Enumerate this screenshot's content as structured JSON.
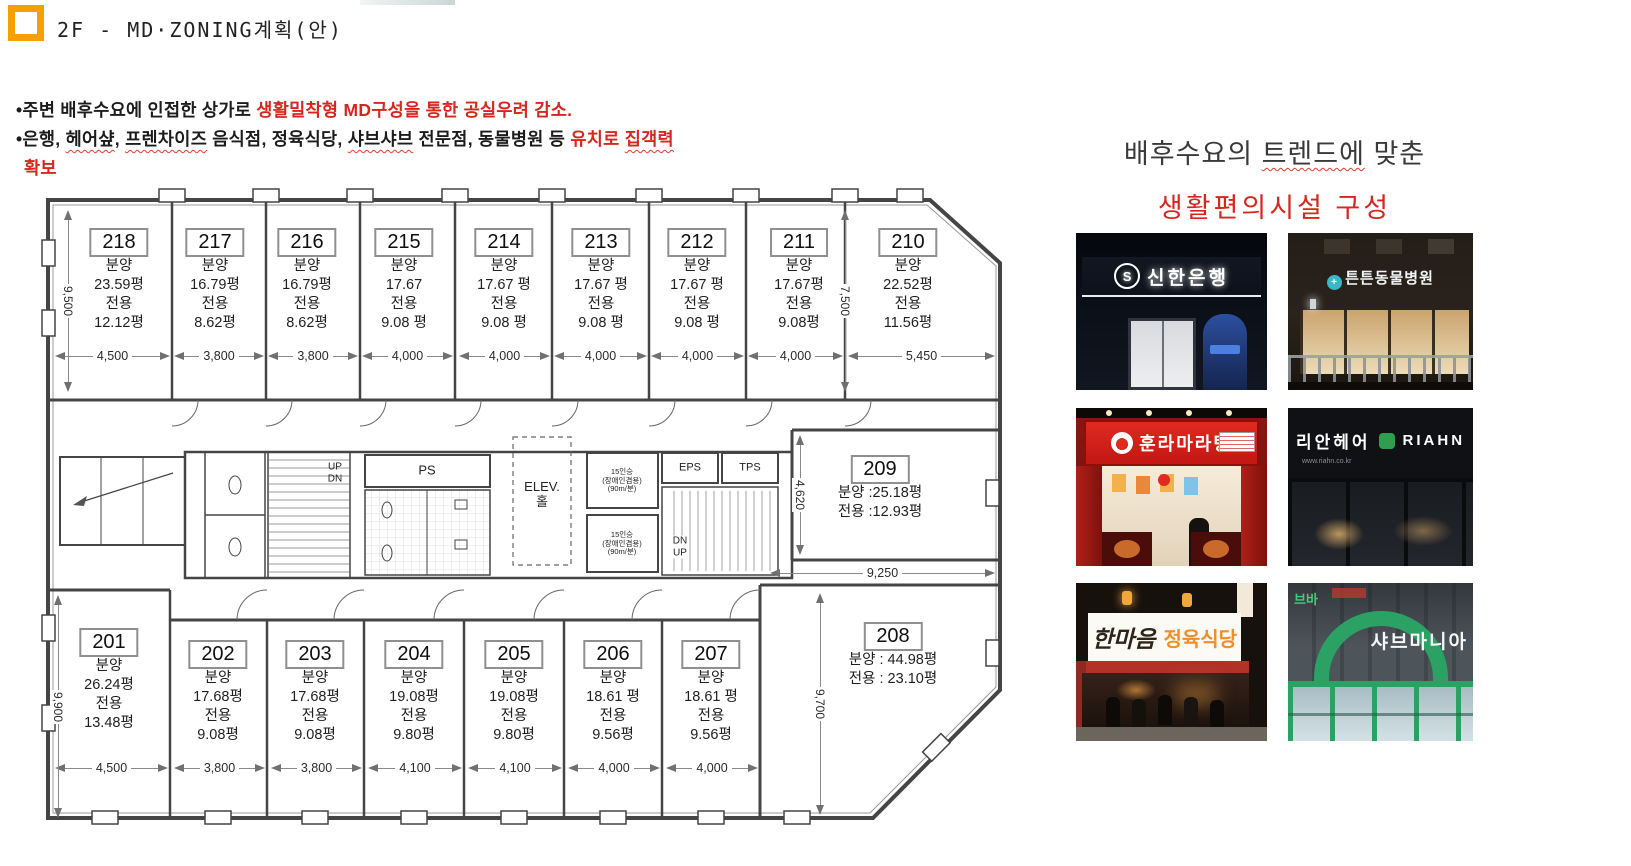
{
  "page": {
    "title": "2F - MD·ZONING계획(안)"
  },
  "colors": {
    "accent_red": "#d8261c",
    "logo_orange": "#f5a000",
    "teal": "#39b7c9",
    "shabu_green": "#2ba264",
    "hair_green": "#2f9e4f"
  },
  "bullets": {
    "b1a": "주변 배후수요에 인접한 상가로 ",
    "b1b": "생활밀착형 MD구성을 통한 공실우려 감소.",
    "b2a": "은행, ",
    "b2b": "헤어샾",
    "b2c": ", ",
    "b2d": "프렌차이즈",
    "b2e": " 음식점, 정육식당, ",
    "b2f": "샤브샤브",
    "b2g": " 전문점, 동물병원  등  ",
    "b2h": "유치로 ",
    "b2i": "집객력",
    "b3": "확보"
  },
  "plan": {
    "units": {
      "u218": {
        "no": "218",
        "l1": "분양",
        "l2": "23.59평",
        "l3": "전용",
        "l4": "12.12평"
      },
      "u217": {
        "no": "217",
        "l1": "분양",
        "l2": "16.79평",
        "l3": "전용",
        "l4": "8.62평"
      },
      "u216": {
        "no": "216",
        "l1": "분양",
        "l2": "16.79평",
        "l3": "전용",
        "l4": "8.62평"
      },
      "u215": {
        "no": "215",
        "l1": "분양",
        "l2": "17.67",
        "l3": "전용",
        "l4": "9.08 평"
      },
      "u214": {
        "no": "214",
        "l1": "분양",
        "l2": "17.67 평",
        "l3": "전용",
        "l4": "9.08 평"
      },
      "u213": {
        "no": "213",
        "l1": "분양",
        "l2": "17.67 평",
        "l3": "전용",
        "l4": "9.08 평"
      },
      "u212": {
        "no": "212",
        "l1": "분양",
        "l2": "17.67 평",
        "l3": "전용",
        "l4": "9.08 평"
      },
      "u211": {
        "no": "211",
        "l1": "분양",
        "l2": "17.67평",
        "l3": "전용",
        "l4": "9.08평"
      },
      "u210": {
        "no": "210",
        "l1": "분양",
        "l2": "22.52평",
        "l3": "전용",
        "l4": "11.56평"
      },
      "u209": {
        "no": "209",
        "l1": "분양 :25.18평",
        "l2": "전용 :12.93평"
      },
      "u208": {
        "no": "208",
        "l1": "분양 : 44.98평",
        "l2": "전용 : 23.10평"
      },
      "u201": {
        "no": "201",
        "l1": "분양",
        "l2": "26.24평",
        "l3": "전용",
        "l4": "13.48평"
      },
      "u202": {
        "no": "202",
        "l1": "분양",
        "l2": "17.68평",
        "l3": "전용",
        "l4": "9.08평"
      },
      "u203": {
        "no": "203",
        "l1": "분양",
        "l2": "17.68평",
        "l3": "전용",
        "l4": "9.08평"
      },
      "u204": {
        "no": "204",
        "l1": "분양",
        "l2": "19.08평",
        "l3": "전용",
        "l4": "9.80평"
      },
      "u205": {
        "no": "205",
        "l1": "분양",
        "l2": "19.08평",
        "l3": "전용",
        "l4": "9.80평"
      },
      "u206": {
        "no": "206",
        "l1": "분양",
        "l2": "18.61 평",
        "l3": "전용",
        "l4": "9.56평"
      },
      "u207": {
        "no": "207",
        "l1": "분양",
        "l2": "18.61 평",
        "l3": "전용",
        "l4": "9.56평"
      }
    },
    "dims": {
      "top": [
        "4,500",
        "3,800",
        "3,800",
        "4,000",
        "4,000",
        "4,000",
        "4,000",
        "4,000",
        "5,450"
      ],
      "bottom": [
        "4,500",
        "3,800",
        "3,800",
        "4,100",
        "4,100",
        "4,000",
        "4,000"
      ],
      "left_top": "9,500",
      "left_bottom": "9,900",
      "right_top": "7,500",
      "mid": "4,620",
      "right_bottom": "9,700",
      "h208": "9,250"
    },
    "core": {
      "up": "UP",
      "dn": "DN",
      "ps": "PS",
      "elev": "ELEV.",
      "hall": "홀",
      "eps": "EPS",
      "tps": "TPS",
      "lift1": "15인승",
      "lift2": "(장애인겸용)",
      "lift3": "(90m/분)",
      "dn2": "DN",
      "up2": "UP"
    }
  },
  "right": {
    "h1a": "배후수요의 ",
    "h1b": "트렌드에",
    "h1c": " 맞춘",
    "h2": "생활편의시설 구성",
    "photos": {
      "p1": {
        "logo": "S",
        "sign": "신한은행"
      },
      "p2": {
        "logo": "+",
        "sign": "튼튼동물병원"
      },
      "p3": {
        "sign": "훈라마라탕"
      },
      "p4": {
        "sign1": "리안헤어",
        "sign2": "RIAHN",
        "url": "www.riahn.co.kr"
      },
      "p5": {
        "sign1": "한마음",
        "sign2": "정육식당"
      },
      "p6": {
        "sign": "샤브마니아",
        "neighbor": "브바"
      }
    }
  }
}
